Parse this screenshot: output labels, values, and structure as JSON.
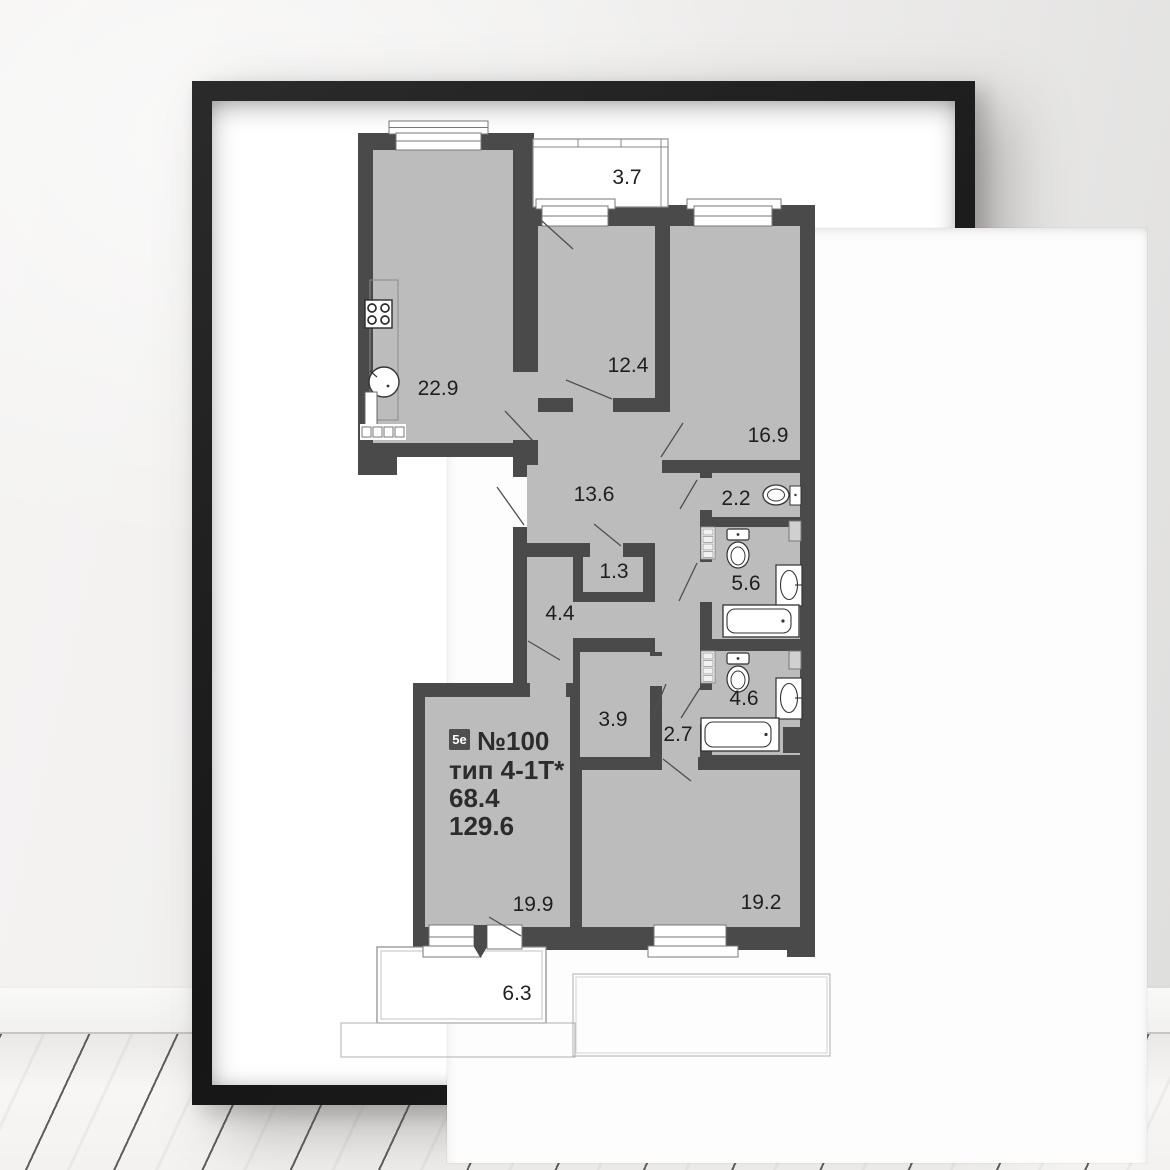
{
  "scene": {
    "description": "framed apartment floor plan poster on a wall above a white wooden plank floor",
    "wall_color": "#efeeec",
    "frame_color": "#1c1c1c",
    "mat_color": "#ffffff"
  },
  "plan": {
    "wall_color": "#4a4a4a",
    "room_fill": "#bcbcbc",
    "badge": "5е",
    "apartment_number": "№100",
    "apartment_type": "тип 4-1Т*",
    "area_living": "68.4",
    "area_total": "129.6",
    "rooms": [
      {
        "id": "balcony-top",
        "area": "3.7"
      },
      {
        "id": "kitchen-living",
        "area": "22.9"
      },
      {
        "id": "bedroom-1",
        "area": "12.4"
      },
      {
        "id": "bedroom-2",
        "area": "16.9"
      },
      {
        "id": "hallway",
        "area": "13.6"
      },
      {
        "id": "wc",
        "area": "2.2"
      },
      {
        "id": "storage",
        "area": "1.3"
      },
      {
        "id": "bathroom-1",
        "area": "5.6"
      },
      {
        "id": "corridor",
        "area": "4.4"
      },
      {
        "id": "wardrobe",
        "area": "3.9"
      },
      {
        "id": "corridor-2",
        "area": "2.7"
      },
      {
        "id": "bathroom-2",
        "area": "4.6"
      },
      {
        "id": "bedroom-3",
        "area": "19.9"
      },
      {
        "id": "living-room",
        "area": "19.2"
      },
      {
        "id": "balcony-bottom",
        "area": "6.3"
      }
    ]
  }
}
